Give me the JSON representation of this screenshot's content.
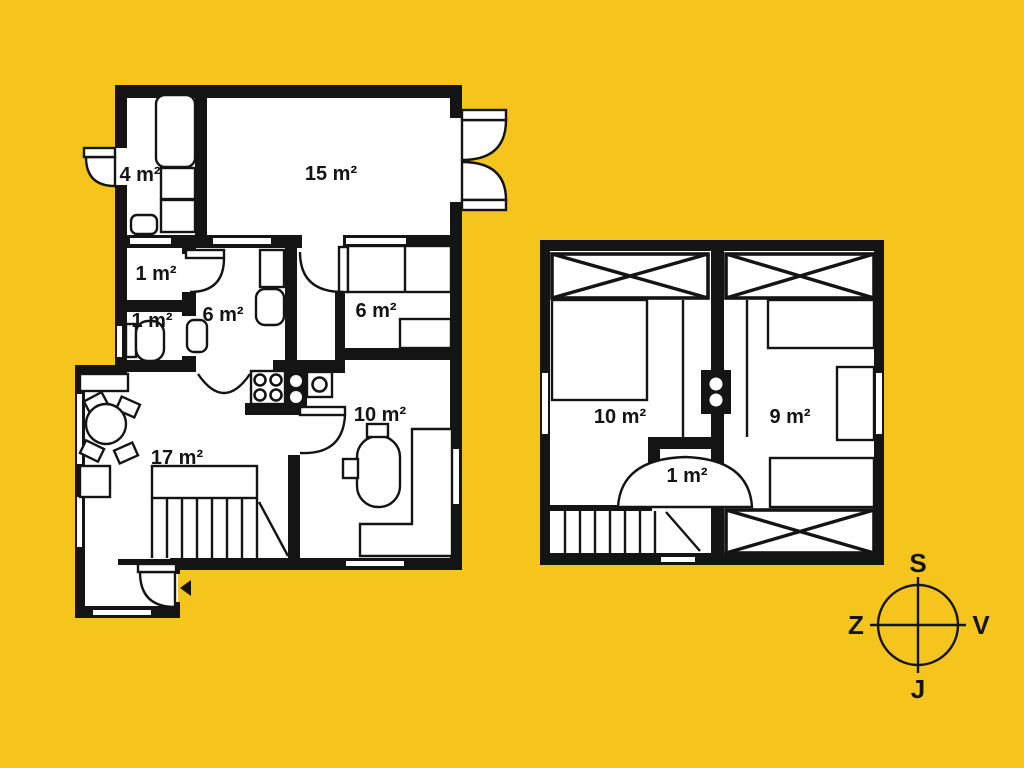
{
  "colors": {
    "background": "#F5C51E",
    "wall": "#141414",
    "room_fill": "#FFFFFF"
  },
  "ground_floor": {
    "rooms": [
      {
        "label": "4 m²"
      },
      {
        "label": "15 m²"
      },
      {
        "label": "1 m²"
      },
      {
        "label": "1 m²"
      },
      {
        "label": "6 m²"
      },
      {
        "label": "6 m²"
      },
      {
        "label": "10 m²"
      },
      {
        "label": "17 m²"
      }
    ]
  },
  "upper_floor": {
    "rooms": [
      {
        "label": "10 m²"
      },
      {
        "label": "9 m²"
      },
      {
        "label": "1 m²"
      }
    ]
  },
  "compass": {
    "north": "S",
    "east": "V",
    "south": "J",
    "west": "Z"
  }
}
